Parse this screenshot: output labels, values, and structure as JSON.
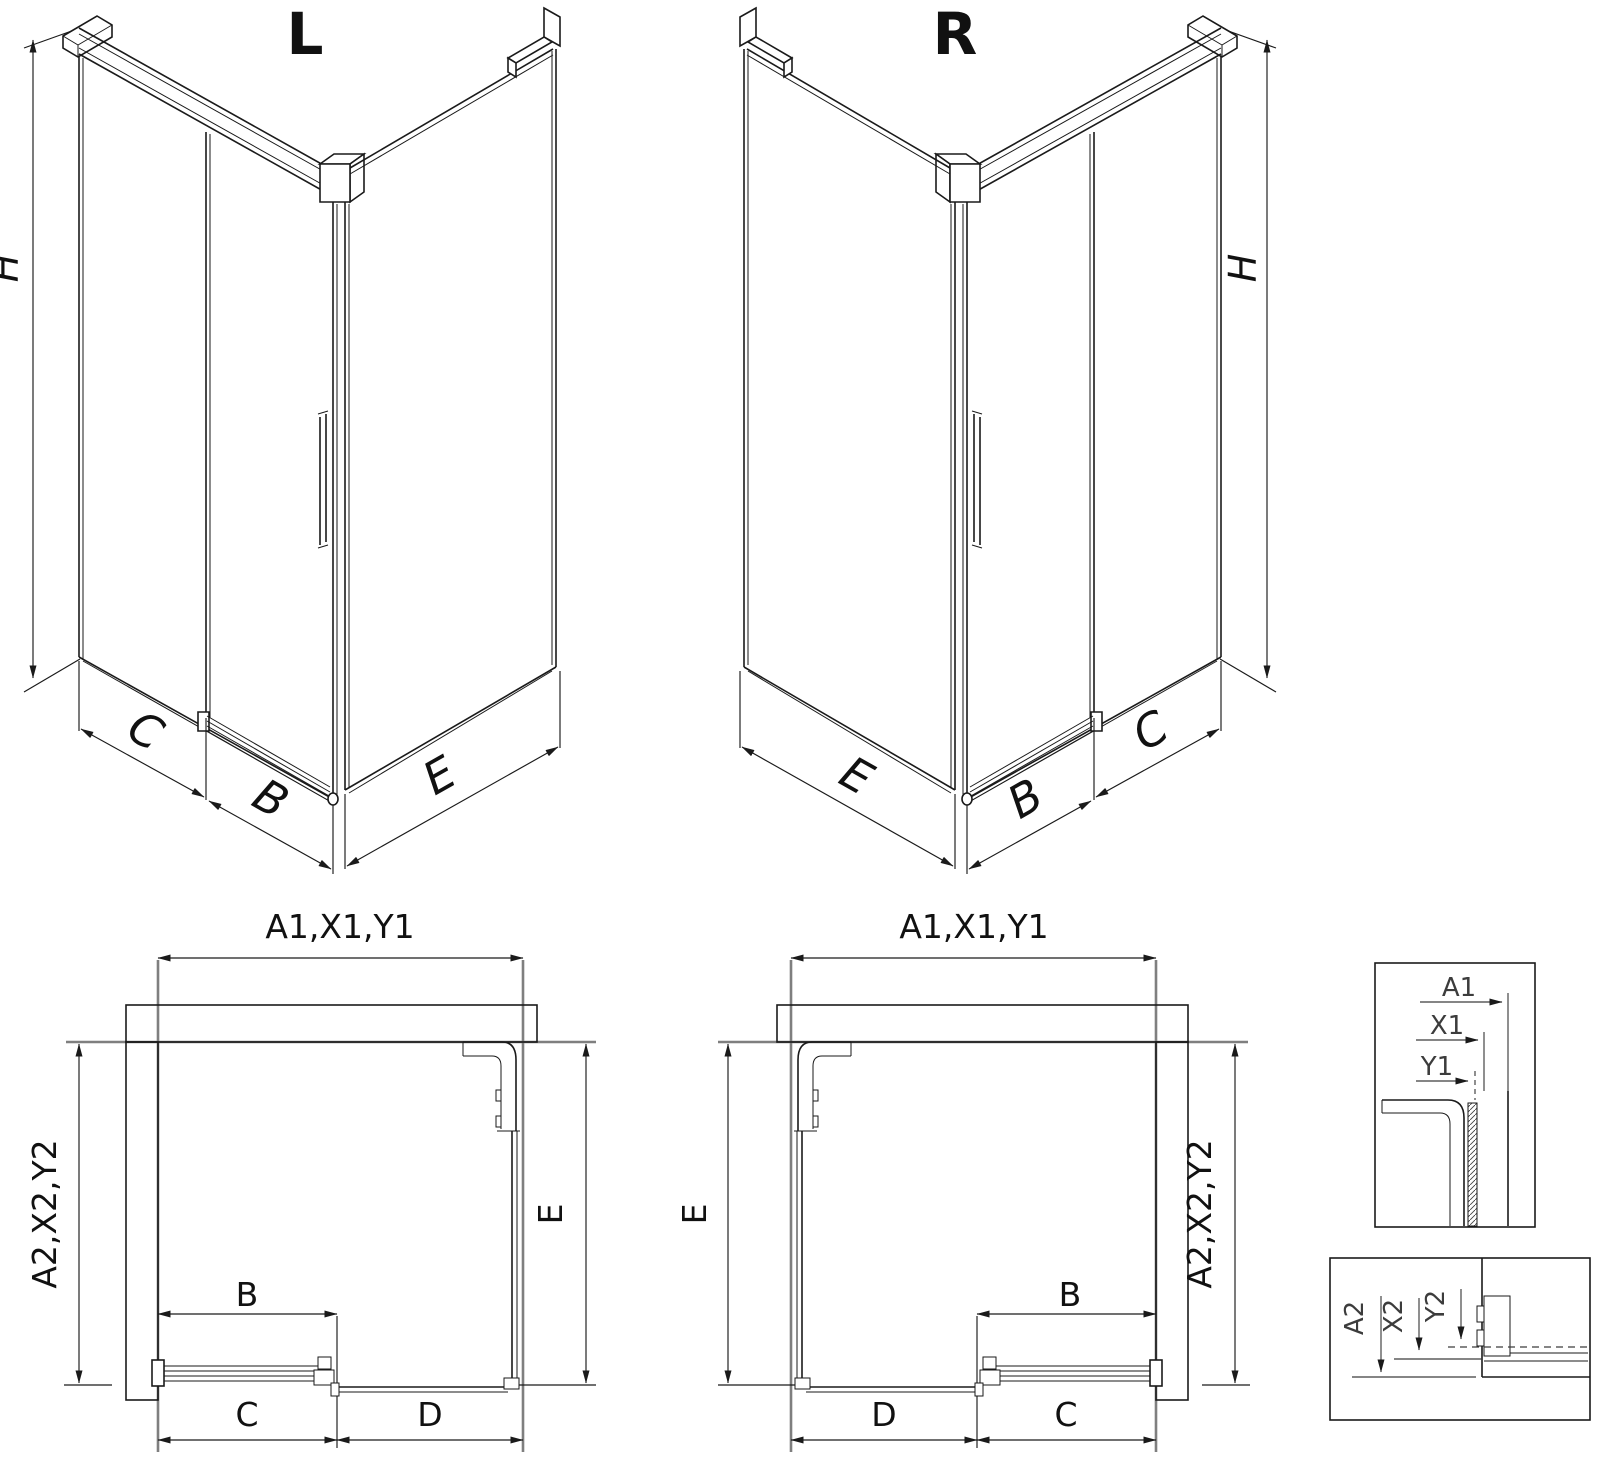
{
  "drawing": {
    "background_color": "#ffffff",
    "line_color": "#1a1a1a",
    "extension_line_color": "#7f7f7f",
    "iso_left": {
      "title": "L",
      "dim_height": "H",
      "dim_wall_panel": "C",
      "dim_door": "B",
      "dim_side_panel": "E"
    },
    "iso_right": {
      "title": "R",
      "dim_height": "H",
      "dim_wall_panel": "C",
      "dim_door": "B",
      "dim_side_panel": "E"
    },
    "plan_left": {
      "dim_width_total": "A1,X1,Y1",
      "dim_depth_total": "A2,X2,Y2",
      "dim_side": "E",
      "dim_door": "B",
      "dim_door_zone": "C",
      "dim_fixed_zone": "D"
    },
    "plan_right": {
      "dim_width_total": "A1,X1,Y1",
      "dim_depth_total": "A2,X2,Y2",
      "dim_side": "E",
      "dim_door": "B",
      "dim_door_zone": "C",
      "dim_fixed_zone": "D"
    },
    "detail_width": {
      "dim_outer": "A1",
      "dim_mid": "X1",
      "dim_inner": "Y1"
    },
    "detail_depth": {
      "dim_outer": "A2",
      "dim_mid": "X2",
      "dim_inner": "Y2"
    }
  }
}
